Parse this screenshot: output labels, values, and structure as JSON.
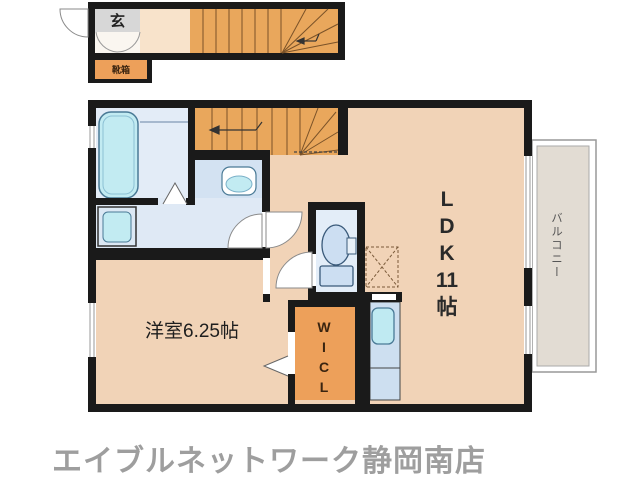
{
  "colors": {
    "wall": "#1a1a1a",
    "floor_peach": "#f1d3b7",
    "hall_cream": "#f8e3cb",
    "stair_orange": "#e9a75c",
    "closet_orange": "#eda05a",
    "entrance_tile_gray": "#d7d7d7",
    "wet_area_blue": "#e3ecf7",
    "fixture_cyan": "#c2ebf2",
    "kitchen_counter_blue": "#cddff0",
    "balcony_gray": "#e2dcd3",
    "brand_gray": "#9e9e9e"
  },
  "floor1": {
    "entrance_label": "玄",
    "shoebox_label": "靴箱"
  },
  "floor2": {
    "ldk": {
      "lines": [
        "L",
        "D",
        "K",
        "11",
        "帖"
      ]
    },
    "western_room": {
      "label": "洋室6.25帖"
    },
    "wicl": {
      "lines": [
        "W",
        "I",
        "C",
        "L"
      ]
    },
    "balcony": {
      "label": "バルコニー"
    }
  },
  "footer": {
    "brand": "エイブルネットワーク静岡南店"
  }
}
